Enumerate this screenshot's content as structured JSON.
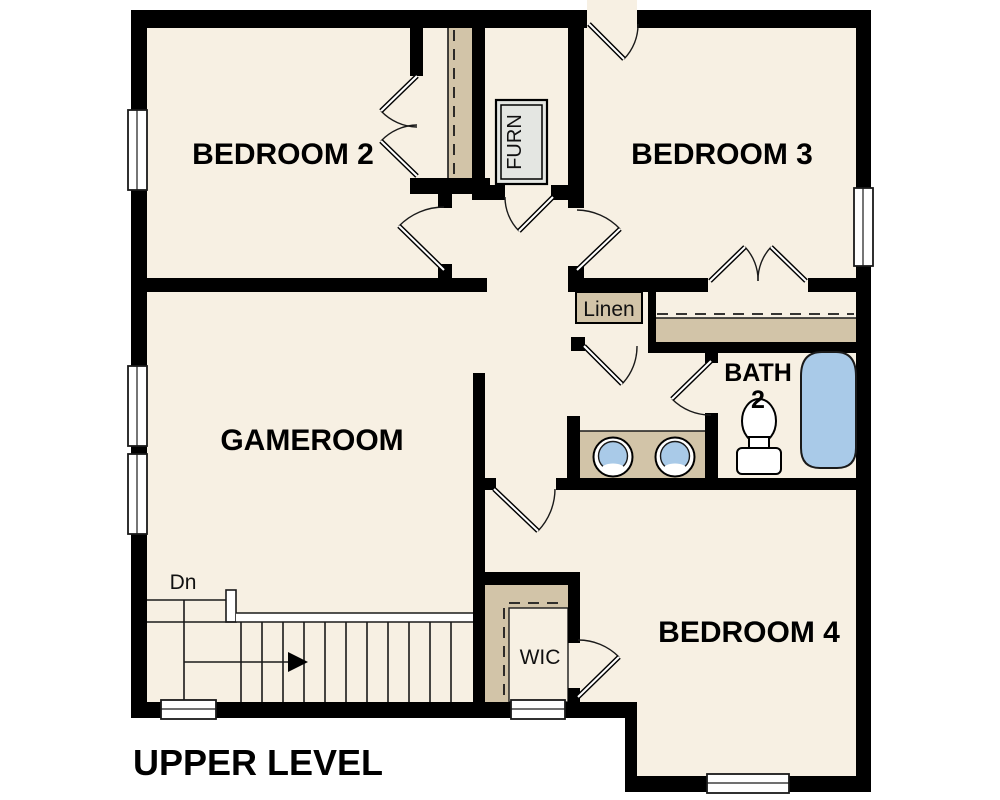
{
  "title": "UPPER LEVEL",
  "rooms": {
    "bedroom2": "BEDROOM 2",
    "bedroom3": "BEDROOM 3",
    "gameroom": "GAMEROOM",
    "bedroom4": "BEDROOM 4",
    "bath": "BATH",
    "bath_number": "2",
    "linen": "Linen",
    "wic": "WIC",
    "furnace": "FURN"
  },
  "annotations": {
    "stairs_down": "Dn"
  },
  "colors": {
    "floor": "#F7F0E3",
    "casework": "#D2C4A8",
    "water": "#A9CAE8",
    "furnace_fill": "#E4E6E2",
    "wall": "#000000",
    "line": "#1A1A1A",
    "background": "#FFFFFF"
  }
}
